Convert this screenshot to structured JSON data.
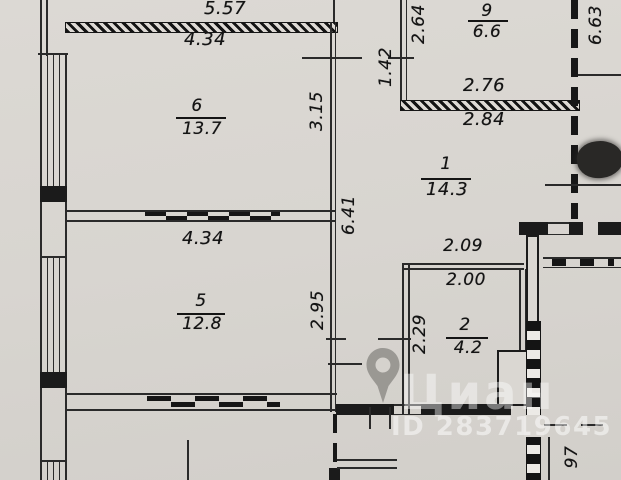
{
  "watermark": {
    "brand": "Циан",
    "listing_id": "ID 283719645"
  },
  "rooms": {
    "r6": {
      "number": "6",
      "area": "13.7"
    },
    "r5": {
      "number": "5",
      "area": "12.8"
    },
    "r9": {
      "number": "9",
      "area": "6.6"
    },
    "r1": {
      "number": "1",
      "area": "14.3"
    },
    "r2": {
      "number": "2",
      "area": "4.2"
    }
  },
  "dims": {
    "top_width": "5.57",
    "r6_width": "4.34",
    "r6_height": "3.15",
    "entry_gap": "1.42",
    "r9_depth": "2.64",
    "r9_length": "6.63",
    "r9_width": "2.76",
    "r1_width": "2.84",
    "hall_height": "6.41",
    "r2_top": "2.09",
    "r2_width": "2.00",
    "r5_width": "4.34",
    "r5_height": "2.95",
    "r2_height": "2.29",
    "shaft": "97"
  }
}
